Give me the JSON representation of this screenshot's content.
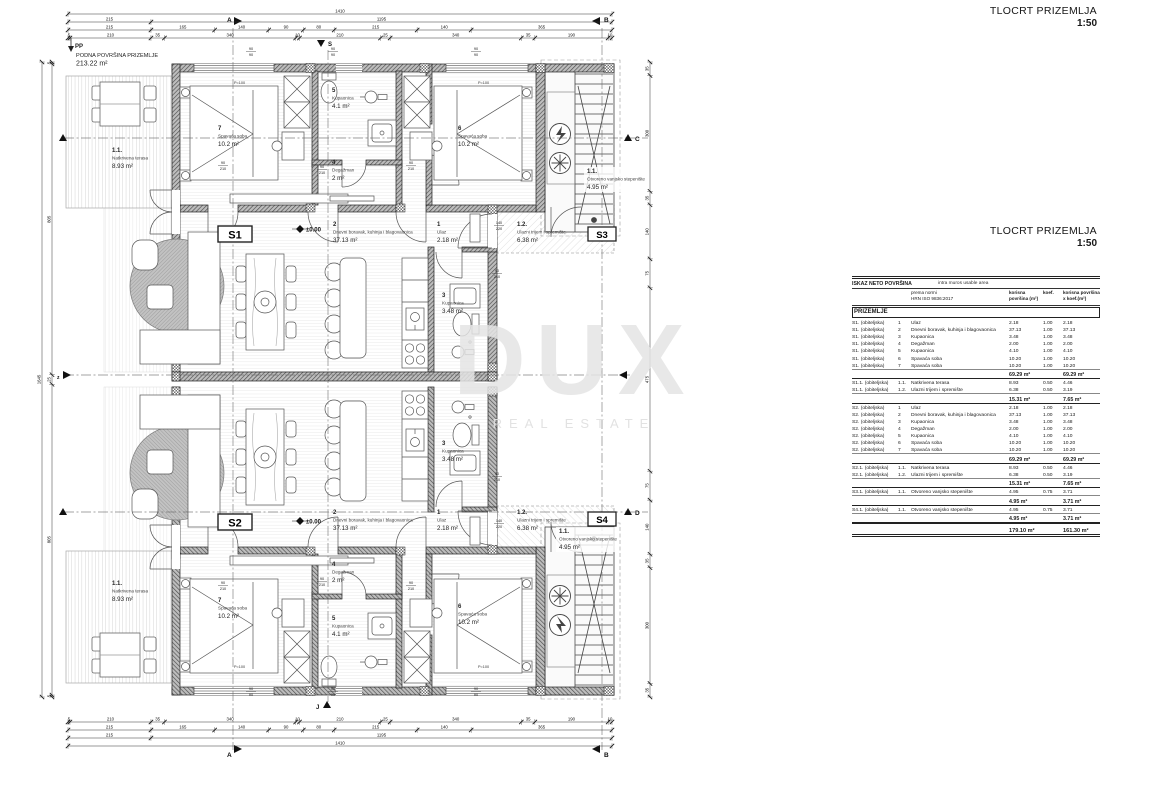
{
  "titles": {
    "block1": {
      "line1": "TLOCRT PRIZEMLJA",
      "scale": "1:50"
    },
    "block2": {
      "line1": "TLOCRT PRIZEMLJA",
      "scale": "1:50"
    }
  },
  "watermark": {
    "line1": "DUX",
    "line2": "REAL ESTATE"
  },
  "plan": {
    "floor_note": {
      "code": "PP",
      "line1": "PODNA POVRŠINA PRIZEMLJE",
      "area": "213.22 m²"
    },
    "markers": {
      "a": "A",
      "b": "B",
      "c": "C",
      "d": "D",
      "s": "S",
      "j": "J",
      "z": "z"
    },
    "units": {
      "s1": {
        "tag": "S1",
        "level": "±0.00",
        "rooms": {
          "terrace": {
            "num": "1.1.",
            "name": "Natkrivena terasa",
            "area": "8.93 m²"
          },
          "bed7": {
            "num": "7",
            "name": "Spavaća soba",
            "area": "10.2 m²"
          },
          "bath5": {
            "num": "5",
            "name": "Kupaonica",
            "area": "4.1 m²"
          },
          "deg4": {
            "num": "4",
            "name": "Degažman",
            "area": "2 m²"
          },
          "bed6": {
            "num": "6",
            "name": "Spavaća soba",
            "area": "10.2 m²"
          },
          "living": {
            "num": "2",
            "name": "Dnevni boravak, kuhinja i blagovaonica",
            "area": "37.13 m²"
          },
          "ulaz": {
            "num": "1",
            "name": "Ulaz",
            "area": "2.18 m²"
          },
          "porch": {
            "num": "1.2.",
            "name": "Ulazni trijem i spremište",
            "area": "6.38 m²"
          },
          "bath3": {
            "num": "3",
            "name": "Kupaonica",
            "area": "3.48 m²"
          }
        }
      },
      "s2": {
        "tag": "S2",
        "level": "±0.00",
        "rooms": {
          "terrace": {
            "num": "1.1.",
            "name": "Natkrivena terasa",
            "area": "8.93 m²"
          },
          "bed7": {
            "num": "7",
            "name": "Spavaća soba",
            "area": "10.2 m²"
          },
          "bath5": {
            "num": "5",
            "name": "Kupaonica",
            "area": "4.1 m²"
          },
          "deg4": {
            "num": "4",
            "name": "Degažman",
            "area": "2 m²"
          },
          "bed6": {
            "num": "6",
            "name": "Spavaća soba",
            "area": "10.2 m²"
          },
          "living": {
            "num": "2",
            "name": "Dnevni boravak, kuhinja i blagovaonica",
            "area": "37.13 m²"
          },
          "ulaz": {
            "num": "1",
            "name": "Ulaz",
            "area": "2.18 m²"
          },
          "porch": {
            "num": "1.2.",
            "name": "Ulazni trijem i spremište",
            "area": "6.38 m²"
          },
          "bath3": {
            "num": "3",
            "name": "Kupaonica",
            "area": "3.48 m²"
          }
        }
      },
      "s3": {
        "tag": "S3",
        "rooms": {
          "stairs": {
            "num": "1.1.",
            "name": "Otvoreno vanjsko stepenište",
            "area": "4.95 m²"
          }
        }
      },
      "s4": {
        "tag": "S4",
        "rooms": {
          "stairs": {
            "num": "1.1.",
            "name": "Otvoreno vanjsko stepenište",
            "area": "4.95 m²"
          }
        }
      }
    },
    "annotations": {
      "p100": "P=100",
      "win_stack": {
        "a": "90",
        "b": "90"
      },
      "door_int": {
        "w": "90",
        "h": "210"
      },
      "door_entry": {
        "w": "140",
        "h": "220"
      }
    },
    "dims": {
      "top": {
        "rows": [
          [
            1410
          ],
          [
            215,
            1195
          ],
          [
            215,
            165,
            140,
            90,
            80,
            215,
            140,
            365
          ],
          [
            5,
            210,
            35,
            340,
            10,
            210,
            25,
            340,
            35,
            190,
            10
          ]
        ]
      },
      "bottom": {
        "rows": [
          [
            5,
            210,
            35,
            340,
            10,
            210,
            25,
            340,
            35,
            190,
            10
          ],
          [
            215,
            165,
            140,
            90,
            80,
            215,
            140,
            365
          ],
          [
            215,
            1195
          ],
          [
            1410
          ]
        ]
      },
      "left": {
        "cols": [
          [
            1645
          ],
          [
            5,
            805,
            25,
            805,
            5
          ]
        ]
      },
      "right": {
        "cols": [
          [
            35,
            300,
            35,
            140,
            75,
            475,
            75,
            140,
            35,
            300,
            35
          ]
        ]
      }
    }
  },
  "table": {
    "title_left": "ISKAZ NETO POVRŠINA",
    "title_right": "intra muros usable area",
    "norm1": "prema normi",
    "norm2": "HRN ISO 9836:2017",
    "col_area": "korisna površina (m²)",
    "col_koef": "koef.",
    "col_area_k": "korisna površina x koef.(m²)",
    "section": "PRIZEMLJE",
    "rows": [
      {
        "t": "data",
        "unit": "S1. (obiteljska)",
        "n": "1",
        "name": "Ulaz",
        "a": "2.18",
        "k": "1.00",
        "ak": "2.18"
      },
      {
        "t": "data",
        "unit": "S1. (obiteljska)",
        "n": "2",
        "name": "Dnevni boravak, kuhinja i blagovaonica",
        "a": "37.13",
        "k": "1.00",
        "ak": "37.13"
      },
      {
        "t": "data",
        "unit": "S1. (obiteljska)",
        "n": "3",
        "name": "Kupaonica",
        "a": "3.48",
        "k": "1.00",
        "ak": "3.48"
      },
      {
        "t": "data",
        "unit": "S1. (obiteljska)",
        "n": "4",
        "name": "Degažman",
        "a": "2.00",
        "k": "1.00",
        "ak": "2.00"
      },
      {
        "t": "data",
        "unit": "S1. (obiteljska)",
        "n": "5",
        "name": "Kupaonica",
        "a": "4.10",
        "k": "1.00",
        "ak": "4.10"
      },
      {
        "t": "data",
        "unit": "S1. (obiteljska)",
        "n": "6",
        "name": "Spavaća soba",
        "a": "10.20",
        "k": "1.00",
        "ak": "10.20"
      },
      {
        "t": "data",
        "unit": "S1. (obiteljska)",
        "n": "7",
        "name": "Spavaća soba",
        "a": "10.20",
        "k": "1.00",
        "ak": "10.20"
      },
      {
        "t": "sub",
        "a": "69.29 m²",
        "ak": "69.29 m²"
      },
      {
        "t": "data",
        "unit": "S1.1. (obiteljska)",
        "n": "1.1.",
        "name": "Natkrivena terasa",
        "a": "8.93",
        "k": "0.50",
        "ak": "4.46"
      },
      {
        "t": "data",
        "unit": "S1.1. (obiteljska)",
        "n": "1.2.",
        "name": "Ulazni trijem i spremište",
        "a": "6.38",
        "k": "0.50",
        "ak": "3.19"
      },
      {
        "t": "sub",
        "a": "15.31 m²",
        "ak": "7.65 m²"
      },
      {
        "t": "data",
        "unit": "S2. (obiteljska)",
        "n": "1",
        "name": "Ulaz",
        "a": "2.18",
        "k": "1.00",
        "ak": "2.18"
      },
      {
        "t": "data",
        "unit": "S2. (obiteljska)",
        "n": "2",
        "name": "Dnevni boravak, kuhinja i blagovaonica",
        "a": "37.13",
        "k": "1.00",
        "ak": "37.13"
      },
      {
        "t": "data",
        "unit": "S2. (obiteljska)",
        "n": "3",
        "name": "Kupaonica",
        "a": "3.48",
        "k": "1.00",
        "ak": "3.48"
      },
      {
        "t": "data",
        "unit": "S2. (obiteljska)",
        "n": "4",
        "name": "Degažman",
        "a": "2.00",
        "k": "1.00",
        "ak": "2.00"
      },
      {
        "t": "data",
        "unit": "S2. (obiteljska)",
        "n": "5",
        "name": "Kupaonica",
        "a": "4.10",
        "k": "1.00",
        "ak": "4.10"
      },
      {
        "t": "data",
        "unit": "S2. (obiteljska)",
        "n": "6",
        "name": "Spavaća soba",
        "a": "10.20",
        "k": "1.00",
        "ak": "10.20"
      },
      {
        "t": "data",
        "unit": "S2. (obiteljska)",
        "n": "7",
        "name": "Spavaća soba",
        "a": "10.20",
        "k": "1.00",
        "ak": "10.20"
      },
      {
        "t": "sub",
        "a": "69.29 m²",
        "ak": "69.29 m²"
      },
      {
        "t": "data",
        "unit": "S2.1. (obiteljska)",
        "n": "1.1.",
        "name": "Natkrivena terasa",
        "a": "8.93",
        "k": "0.50",
        "ak": "4.46"
      },
      {
        "t": "data",
        "unit": "S2.1. (obiteljska)",
        "n": "1.2.",
        "name": "Ulazni trijem i spremište",
        "a": "6.38",
        "k": "0.50",
        "ak": "3.19"
      },
      {
        "t": "sub",
        "a": "15.31 m²",
        "ak": "7.65 m²"
      },
      {
        "t": "data",
        "unit": "S3.1. (obiteljska)",
        "n": "1.1.",
        "name": "Otvoreno vanjsko stepenište",
        "a": "4.95",
        "k": "0.75",
        "ak": "3.71"
      },
      {
        "t": "sub",
        "a": "4.95 m²",
        "ak": "3.71 m²"
      },
      {
        "t": "data",
        "unit": "S4.1. (obiteljska)",
        "n": "1.1.",
        "name": "Otvoreno vanjsko stepenište",
        "a": "4.95",
        "k": "0.75",
        "ak": "3.71"
      },
      {
        "t": "sub",
        "a": "4.95 m²",
        "ak": "3.71 m²"
      },
      {
        "t": "total",
        "a": "179.10 m²",
        "ak": "161.30 m²"
      }
    ]
  }
}
